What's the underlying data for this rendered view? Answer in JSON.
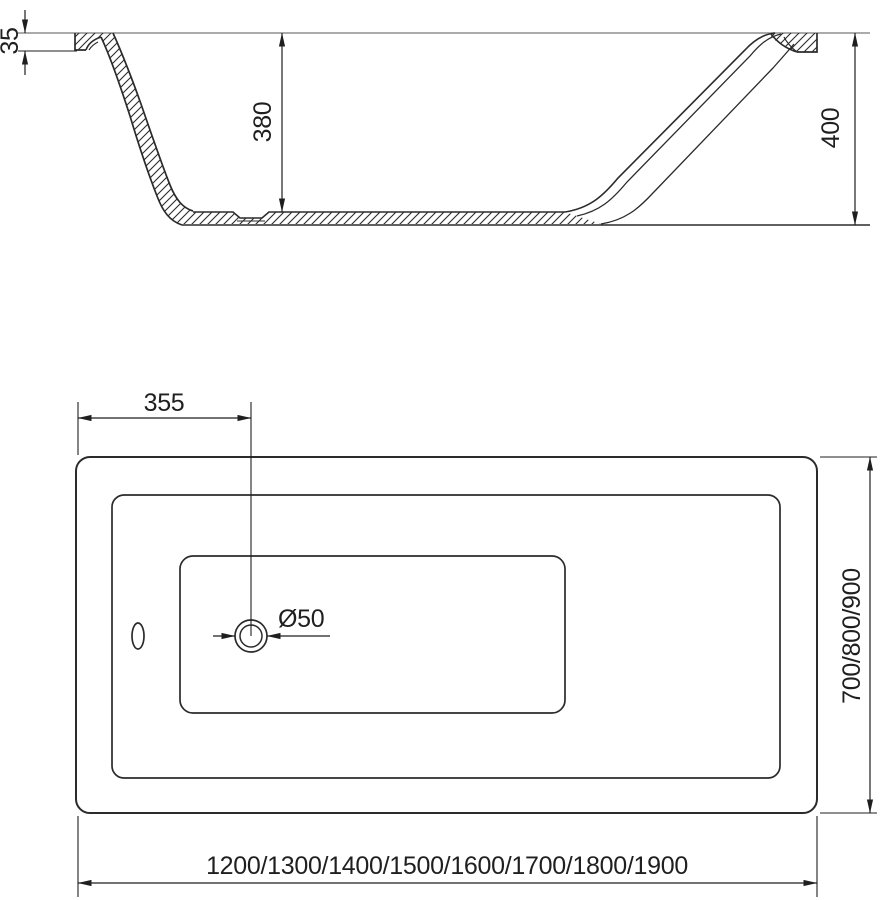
{
  "section_view": {
    "rim_thickness": "35",
    "inner_depth": "380",
    "overall_height": "400"
  },
  "plan_view": {
    "drain_offset": "355",
    "drain_diameter": "Ø50",
    "width_options": "700/800/900",
    "length_options": "1200/1300/1400/1500/1600/1700/1800/1900"
  },
  "colors": {
    "line": "#2b2b2b",
    "dim": "#1f1f1f",
    "rim_line": "#8f8f8f",
    "background": "#ffffff"
  }
}
